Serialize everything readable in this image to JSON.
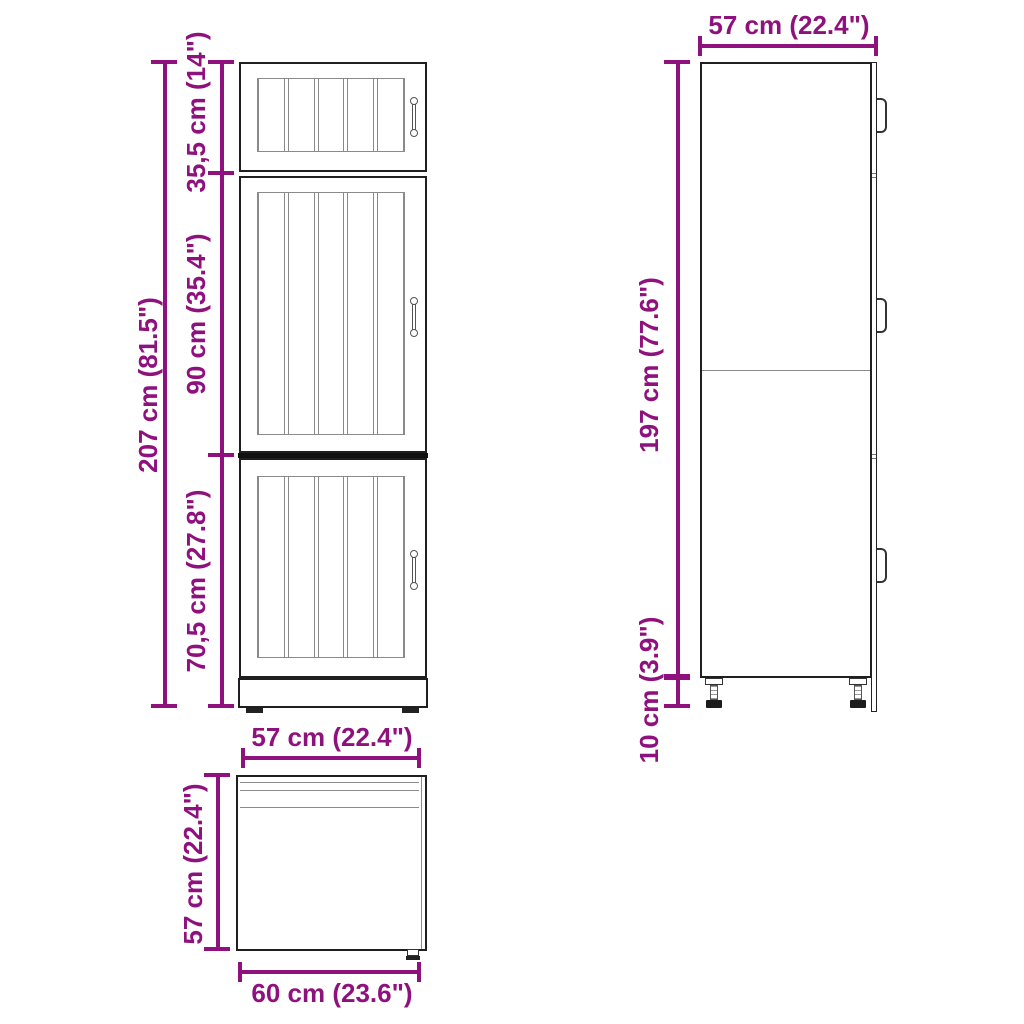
{
  "front_view": {
    "total_height": "207 cm (81.5\")",
    "top_section": "35,5 cm (14\")",
    "middle_section": "90 cm (35.4\")",
    "bottom_section": "70,5 cm (27.8\")"
  },
  "side_view": {
    "width": "57 cm (22.4\")",
    "body_height": "197 cm (77.6\")",
    "leg_height": "10 cm (3.9\")"
  },
  "top_view": {
    "width": "57 cm (22.4\")",
    "depth": "57 cm (22.4\")",
    "total_depth": "60 cm (23.6\")"
  },
  "colors": {
    "dimension": "#8F117E",
    "outline": "#1f1f1f",
    "inner_line": "#8a8a8a"
  }
}
